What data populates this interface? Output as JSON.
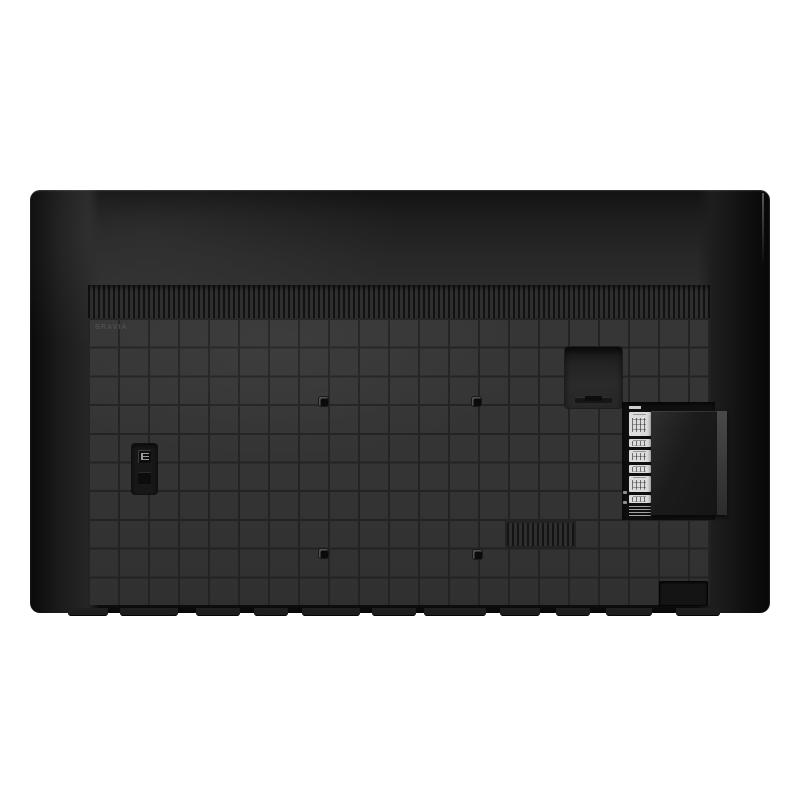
{
  "scene": {
    "type": "product-photo",
    "subject": "rear view of a flat-screen television",
    "background_color": "#ffffff"
  },
  "tv": {
    "brand_label": "BRAVIA",
    "colors": {
      "body_gray": "#2c2c2c",
      "grid_cell": "#343434",
      "grid_line": "#232323",
      "edge_black": "#0a0a0a",
      "port_label_chip": "#dcdcdc"
    },
    "rear_features": {
      "vesa_mount_hole_count": 4,
      "port_label_icons": [
        "antenna-port-icon",
        "av-input-icon",
        "hdmi-port-icon",
        "usb-port-icon",
        "lan-port-icon",
        "optical-audio-icon"
      ]
    }
  }
}
